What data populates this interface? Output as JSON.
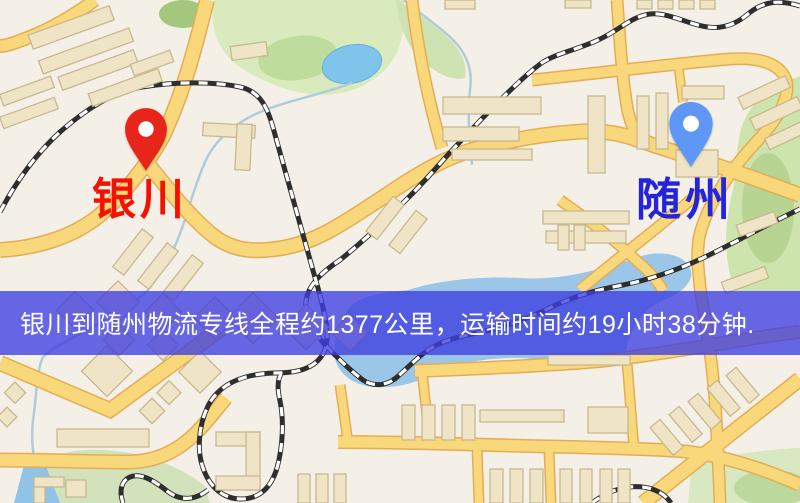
{
  "map": {
    "origin": {
      "label": "银川",
      "pin_color": "#e8251a",
      "label_color": "#f61000"
    },
    "destination": {
      "label": "随州",
      "pin_color": "#5f97f4",
      "label_color": "#2424dd"
    },
    "banner": {
      "text": "银川到随州物流专线全程约1377公里，运输时间约19小时38分钟.",
      "background": "rgba(62,62,225,0.78)",
      "text_color": "#ffffff",
      "distance_text": "1377公里",
      "duration_text": "19小时38分钟"
    },
    "map_colors": {
      "background": "#f4f0e8",
      "road_fill": "#f8d87a",
      "road_casing": "#e4ad55",
      "water": "#9cc6e8",
      "park": "#d9eabc",
      "building": "#efe5c6",
      "railway_dark": "#2e2e2e"
    }
  }
}
